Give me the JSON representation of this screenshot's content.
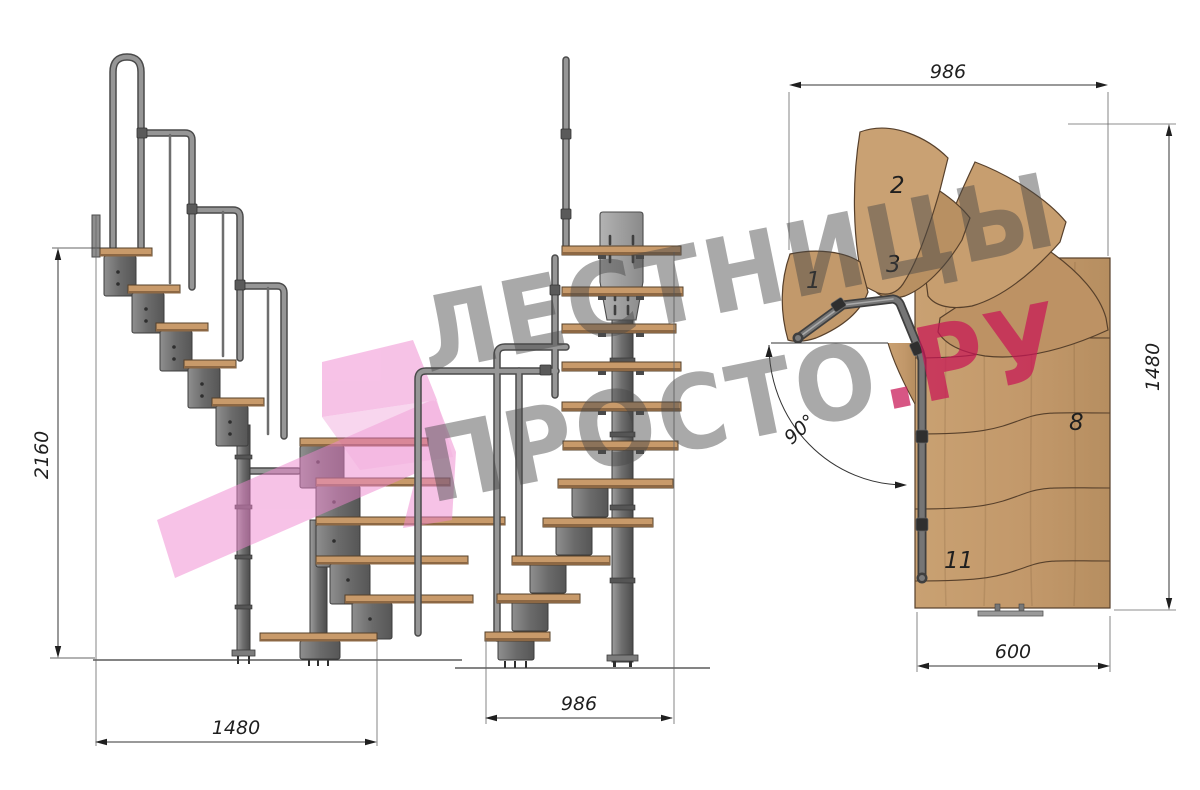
{
  "image_type": "technical drawing of a modular winder staircase, three views with dimensions",
  "watermark": {
    "line1": "ЛЕСТНИЦЫ",
    "line2_gray": "ПРОСТО",
    "line2_pink": ".РУ",
    "gray_color": "#9b9b9b",
    "pink_color": "#d1477a",
    "ribbon_color": "#ef86cf"
  },
  "views": {
    "side_elevation": {
      "dimensions": {
        "total_height": "2160",
        "total_run": "1480"
      }
    },
    "front_elevation": {
      "dimensions": {
        "width": "986"
      }
    },
    "plan_view": {
      "dimensions": {
        "top_width": "986",
        "depth": "1480",
        "flight_width": "600",
        "turn_angle": "90°"
      },
      "step_labels": [
        "1",
        "2",
        "3",
        "8",
        "11"
      ]
    }
  },
  "colors": {
    "background": "#ffffff",
    "dimension_lines": "#1f1f1f",
    "wood_light": "#c9a172",
    "wood_mid": "#c0966a",
    "wood_dark": "#b08a5c",
    "wood_outline": "#57402b",
    "metal_light": "#9a9a9a",
    "metal_mid": "#787878",
    "metal_dark": "#3f3f3f"
  }
}
